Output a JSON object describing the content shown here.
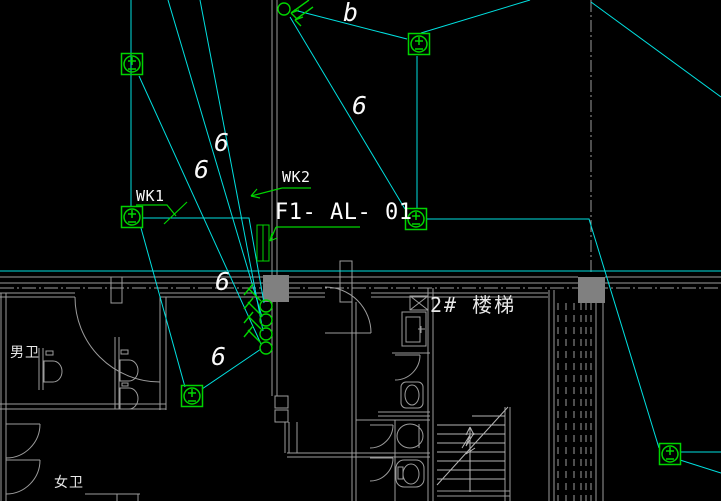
{
  "labels": {
    "panel": "F1- AL- 01",
    "wk1": "WK1",
    "wk2": "WK2",
    "phase": "b",
    "wire_count": "6",
    "stair_room": "2# 楼梯",
    "male_wc": "男卫",
    "female_wc": "女卫"
  },
  "colors": {
    "background": "#000000",
    "wire": "#00e0e0",
    "symbol_green": "#00d400",
    "text": "#f0f0f0",
    "wall": "#9c9c9c",
    "stair_lines": "#b4b4b4",
    "column_fill": "#808080"
  },
  "symbols": {
    "ceiling_lamp": "lamp-circle-plus-minus-icon",
    "riser": "wires-up-arrow-icon",
    "drop_point": "wire-drop-circle-icon",
    "distribution_panel": "panel-box-icon",
    "lamp_count": 6,
    "drop_point_count": 4
  }
}
